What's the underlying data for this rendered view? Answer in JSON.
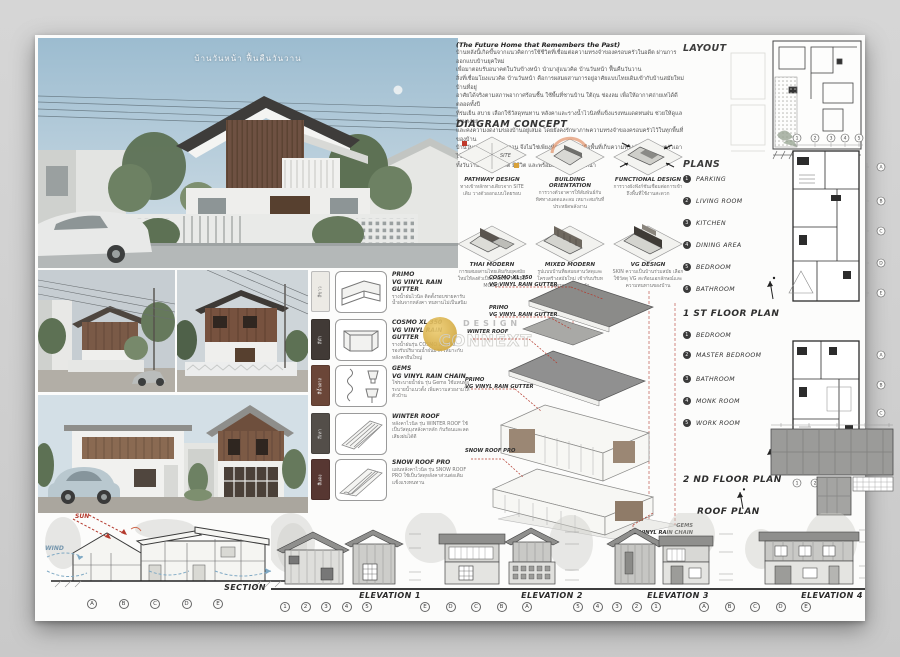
{
  "page": {
    "render_title": "บ้านวันหน้า ฟื้นคืนวันวาน"
  },
  "intro": {
    "heading": "(The Future Home that Remembers the Past)",
    "lines": [
      "บ้านหลังนี้เกิดขึ้นจากแนวคิดการใช้ชีวิตที่เชื่อมต่อความทรงจำของครอบครัวในอดีต ผ่านการออกแบบบ้านยุคใหม่",
      "เพื่อมาตอบรับอนาคตในวันข้างหน้า นำมาสู่แนวคิด บ้านวันหน้า ฟื้นคืนวันวาน",
      "สิ่งที่เชื่อมโยงแนวคิด บ้านวันหน้า คือการผสมผสานการอยู่อาศัยแบบไทยเดิมเข้ากับบ้านสมัยใหม่ บ้านที่อยู่",
      "อาศัยได้จริงตามสภาพอากาศร้อนชื้น ใช้พื้นที่ชานบ้าน ใต้ถุน ช่องลม เพื่อให้อากาศถ่ายเทได้ดีตลอดทั้งปี",
      "ที่ร่มเย็น สบาย เลือกใช้วัสดุทนทาน หลังคาและรางน้ำไวนิลที่แข็งแรงทนแดดทนฝน ช่วยให้ดูแลรักษาง่าย",
      "และคงความงดงามของบ้านอยู่เสมอ โดยยังคงรักษาภาพความทรงจำของครอบครัวไว้ในทุกพื้นที่ของบ้าน",
      "บ้านวันหน้า ฟื้นคืนวันวาน จึงไม่ใช่เพียงที่อยู่อาศัย แต่คือพื้นที่เก็บความทรงจำของครอบครัวเอาไว้",
      "ทั้งวันวานจนถึงอนาคต มีชีวิต และพร้อมส่งต่อสู่วันข้างหน้า"
    ]
  },
  "diagram_concept": {
    "title": "DIAGRAM CONCEPT",
    "items": [
      {
        "name": "PATHWAY DESIGN",
        "tag": "SITE",
        "caption": "ทางเข้าหลักทางเดียวจาก SITE เดิม วางตัวออกแบบโดยรอบ"
      },
      {
        "name": "BUILDING ORIENTATION",
        "caption": "การวางตัวอาคารให้สัมพันธ์กับทิศทางแดดและลม เหมาะสมกับที่ประหยัดพลังงาน"
      },
      {
        "name": "FUNCTIONAL DESIGN",
        "caption": "การวางผังฟังก์ชันเชื่อมต่อการเข้าถึงพื้นที่ใช้งานสะดวก"
      },
      {
        "name": "THAI MODERN",
        "caption": "การผสมผสานไทยเดิมกับยุคสมัยใหม่ให้ลงตัวเป็นบ้านแบบ MIXED MODEL"
      },
      {
        "name": "MIXED MODERN",
        "caption": "รูปแบบบ้านที่ผสมผสานวัสดุและโครงสร้างสมัยใหม่ เข้ากับบริบทโดยรอบอย่างลงตัว"
      },
      {
        "name": "VG DESIGN",
        "caption": "SKIN ความเป็นบ้านร่วมสมัย เลือกใช้วัสดุ VG สะท้อนเอกลักษณ์และความทนทานของบ้าน"
      }
    ]
  },
  "materials": {
    "items": [
      {
        "name": "PRIMO",
        "sub": "VG VINYL RAIN GUTTER",
        "desc": "รางน้ำฝนไวนิล ติดตั้งรอบชายคารับน้ำฝนจากหลังคา ทนทานไม่เป็นสนิม",
        "swatch_label": "สีขาว",
        "swatch": "#eceae5"
      },
      {
        "name": "COSMO XL 350",
        "sub": "VG VINYL RAIN GUTTER",
        "desc": "รางน้ำฝนรุ่น COSMO XL 350 รองรับปริมาณน้ำฝนมาก เหมาะกับหลังคาผืนใหญ่",
        "swatch_label": "สีดำ",
        "swatch": "#413a36"
      },
      {
        "name": "GEMS",
        "sub": "VG VINYL RAIN CHAIN",
        "desc": "โซ่ระบายน้ำฝน รุ่น Gems ใช้แทนท่อระบายน้ำแนวตั้ง เพิ่มความสวยงามให้ตัวบ้าน",
        "swatch_label": "สีน้ำตาล",
        "swatch": "#6b4638"
      },
      {
        "name": "WINTER ROOF",
        "sub": "",
        "desc": "หลังคาไวนิล รุ่น WINTER ROOF ใช้เป็นวัสดุมุงหลังคาหลัก กันร้อนและลดเสียงฝนได้ดี",
        "swatch_label": "สีเทา",
        "swatch": "#534e49"
      },
      {
        "name": "SNOW ROOF PRO",
        "sub": "",
        "desc": "แผ่นหลังคาไวนิล รุ่น SNOW ROOF PRO ใช้เป็นวัสดุหลังคาส่วนต่อเติม แข็งแรงทนทาน",
        "swatch_label": "สีแดง",
        "swatch": "#573732"
      }
    ]
  },
  "axon": {
    "callouts": [
      {
        "name": "COSMO XL 350",
        "sub": "VG VINYL RAIN GUTTER"
      },
      {
        "name": "PRIMO",
        "sub": "VG VINYL RAIN GUTTER"
      },
      {
        "name": "WINTER ROOF",
        "sub": ""
      },
      {
        "name": "PRIMO",
        "sub": "VG VINYL RAIN GUTTER"
      },
      {
        "name": "SNOW ROOF PRO",
        "sub": ""
      },
      {
        "name": "GEMS",
        "sub": "VG VINYL RAIN CHAIN"
      }
    ],
    "watermark_top": "DESIGN",
    "watermark_bottom": "CONNEXT"
  },
  "right": {
    "layout_title": "LAYOUT",
    "plans_title": "PLANS",
    "floor1": {
      "label": "1 ST FLOOR PLAN",
      "items": [
        {
          "n": "1",
          "label": "PARKING"
        },
        {
          "n": "2",
          "label": "LIVING ROOM"
        },
        {
          "n": "3",
          "label": "KITCHEN"
        },
        {
          "n": "4",
          "label": "DINING AREA"
        },
        {
          "n": "5",
          "label": "BEDROOM"
        },
        {
          "n": "6",
          "label": "BATHROOM"
        }
      ]
    },
    "floor2": {
      "label": "2 ND FLOOR PLAN",
      "items": [
        {
          "n": "1",
          "label": "BEDROOM"
        },
        {
          "n": "2",
          "label": "MASTER BEDROOM"
        },
        {
          "n": "3",
          "label": "BATHROOM"
        },
        {
          "n": "4",
          "label": "MONK ROOM"
        },
        {
          "n": "5",
          "label": "WORK ROOM"
        }
      ]
    },
    "roof_label": "ROOF PLAN",
    "plan_cols": [
      "1",
      "2",
      "3",
      "4",
      "5"
    ],
    "plan_rows": [
      "A",
      "B",
      "C",
      "D",
      "E"
    ]
  },
  "bottom": {
    "section_label": "SECTION",
    "sun_label": "SUN",
    "wind_label": "WIND",
    "elevation_labels": [
      "ELEVATION 1",
      "ELEVATION 2",
      "ELEVATION 3",
      "ELEVATION 4"
    ],
    "section_bubbles": [
      "A",
      "B",
      "C",
      "D",
      "E"
    ],
    "elev1_bubbles": [
      "1",
      "2",
      "3",
      "4",
      "5"
    ],
    "elev2_bubbles": [
      "E",
      "D",
      "C",
      "B",
      "A"
    ],
    "elev3_bubbles": [
      "5",
      "4",
      "3",
      "2",
      "1"
    ],
    "elev4_bubbles": [
      "A",
      "B",
      "C",
      "D",
      "E"
    ]
  }
}
